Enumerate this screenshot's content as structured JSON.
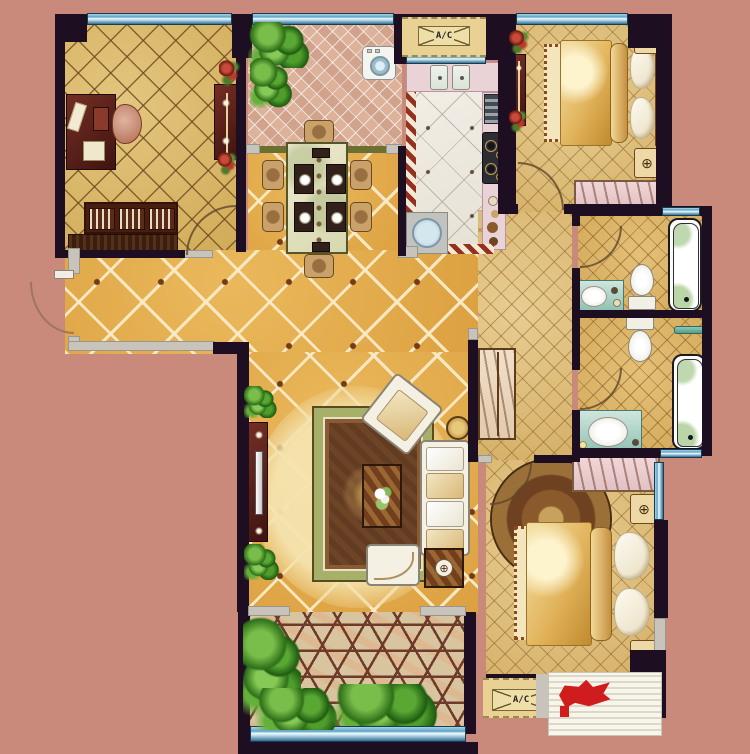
{
  "labels": {
    "ac_top": "A/C",
    "ac_bottom": "A/C"
  },
  "glyphs": {
    "lamp": "⊕"
  },
  "colors": {
    "bg": "#ca8a7b",
    "wall": "#1d0f21",
    "window_blue": "#5da3c4",
    "floor_gold": "#e2a94e",
    "floor_tan": "#d9b76a",
    "floor_bedroom": "#dec07f",
    "kitchen_floor": "#efeae0",
    "counter_pink": "#ead3d7",
    "balcony_mosaic": "#dcb29b",
    "hex_tile_line": "#6e3a2a",
    "furniture_maroon": "#5c2220",
    "vanity_teal": "#8fc0b2",
    "bedding_gold": "#e2b45c",
    "rug_green": "#a6b068",
    "rug_brown": "#6e4426",
    "plant_green": "#3e7d2a",
    "flower_red": "#c84a3a",
    "ac_platform": "#e8d193",
    "logo_red": "#cf1d1d"
  }
}
